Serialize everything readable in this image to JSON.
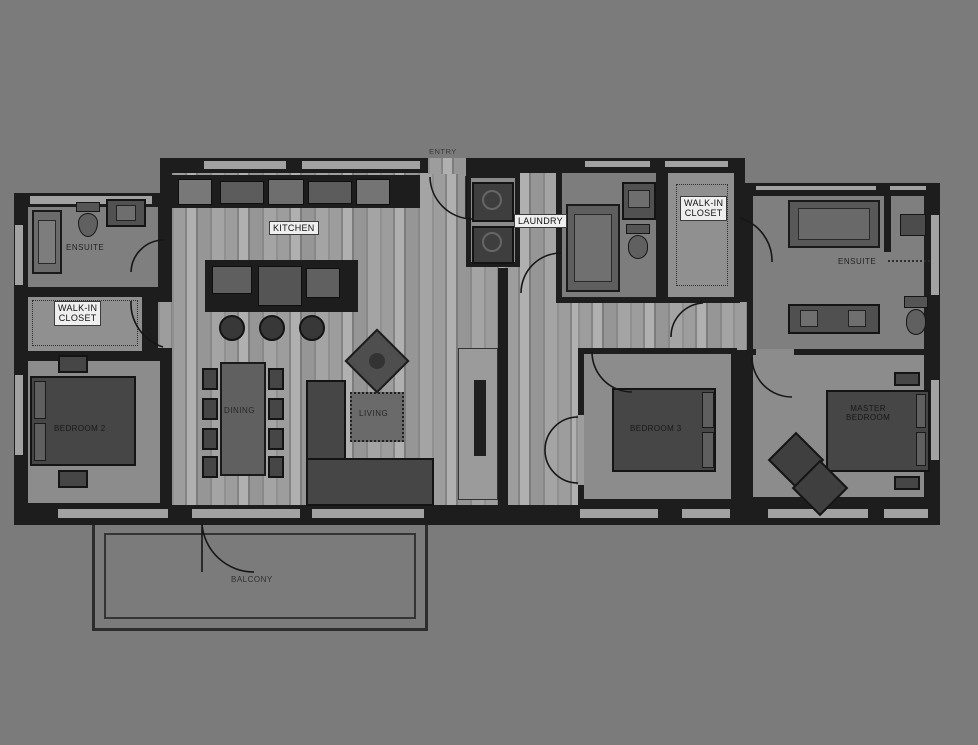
{
  "scene": {
    "type": "residential floor plan, dark monochrome style",
    "floors": "vertical wood-plank flooring in living areas, plain carpet in bedrooms"
  },
  "colors": {
    "background": "#7b7b7b",
    "walls": "#1d1d1d",
    "wood_floor_light": "#b0b0b0",
    "wood_floor_mid": "#909090",
    "carpet": "#8c8c8c",
    "bath_floor": "#7f7f7f",
    "furniture_dark": "#464646",
    "label_box_bg": "#efefef",
    "label_text": "#111111",
    "window": "#a2a2a2"
  },
  "rooms": {
    "kitchen": {
      "label": "KITCHEN"
    },
    "laundry": {
      "label": "LAUNDRY"
    },
    "walk_in_closet_left": {
      "label_line1": "WALK-IN",
      "label_line2": "CLOSET"
    },
    "walk_in_closet_right": {
      "label_line1": "WALK-IN",
      "label_line2": "CLOSET"
    },
    "ensuite_left": {
      "label": "ENSUITE"
    },
    "ensuite_right": {
      "label": "ENSUITE"
    },
    "living": {
      "label": "LIVING"
    },
    "dining": {
      "label": "DINING"
    },
    "bedroom_2": {
      "label": "BEDROOM 2"
    },
    "bedroom_3": {
      "label": "BEDROOM 3"
    },
    "master_bedroom": {
      "label_line1": "MASTER",
      "label_line2": "BEDROOM"
    },
    "balcony": {
      "label": "BALCONY"
    },
    "entry": {
      "label": "ENTRY"
    }
  }
}
